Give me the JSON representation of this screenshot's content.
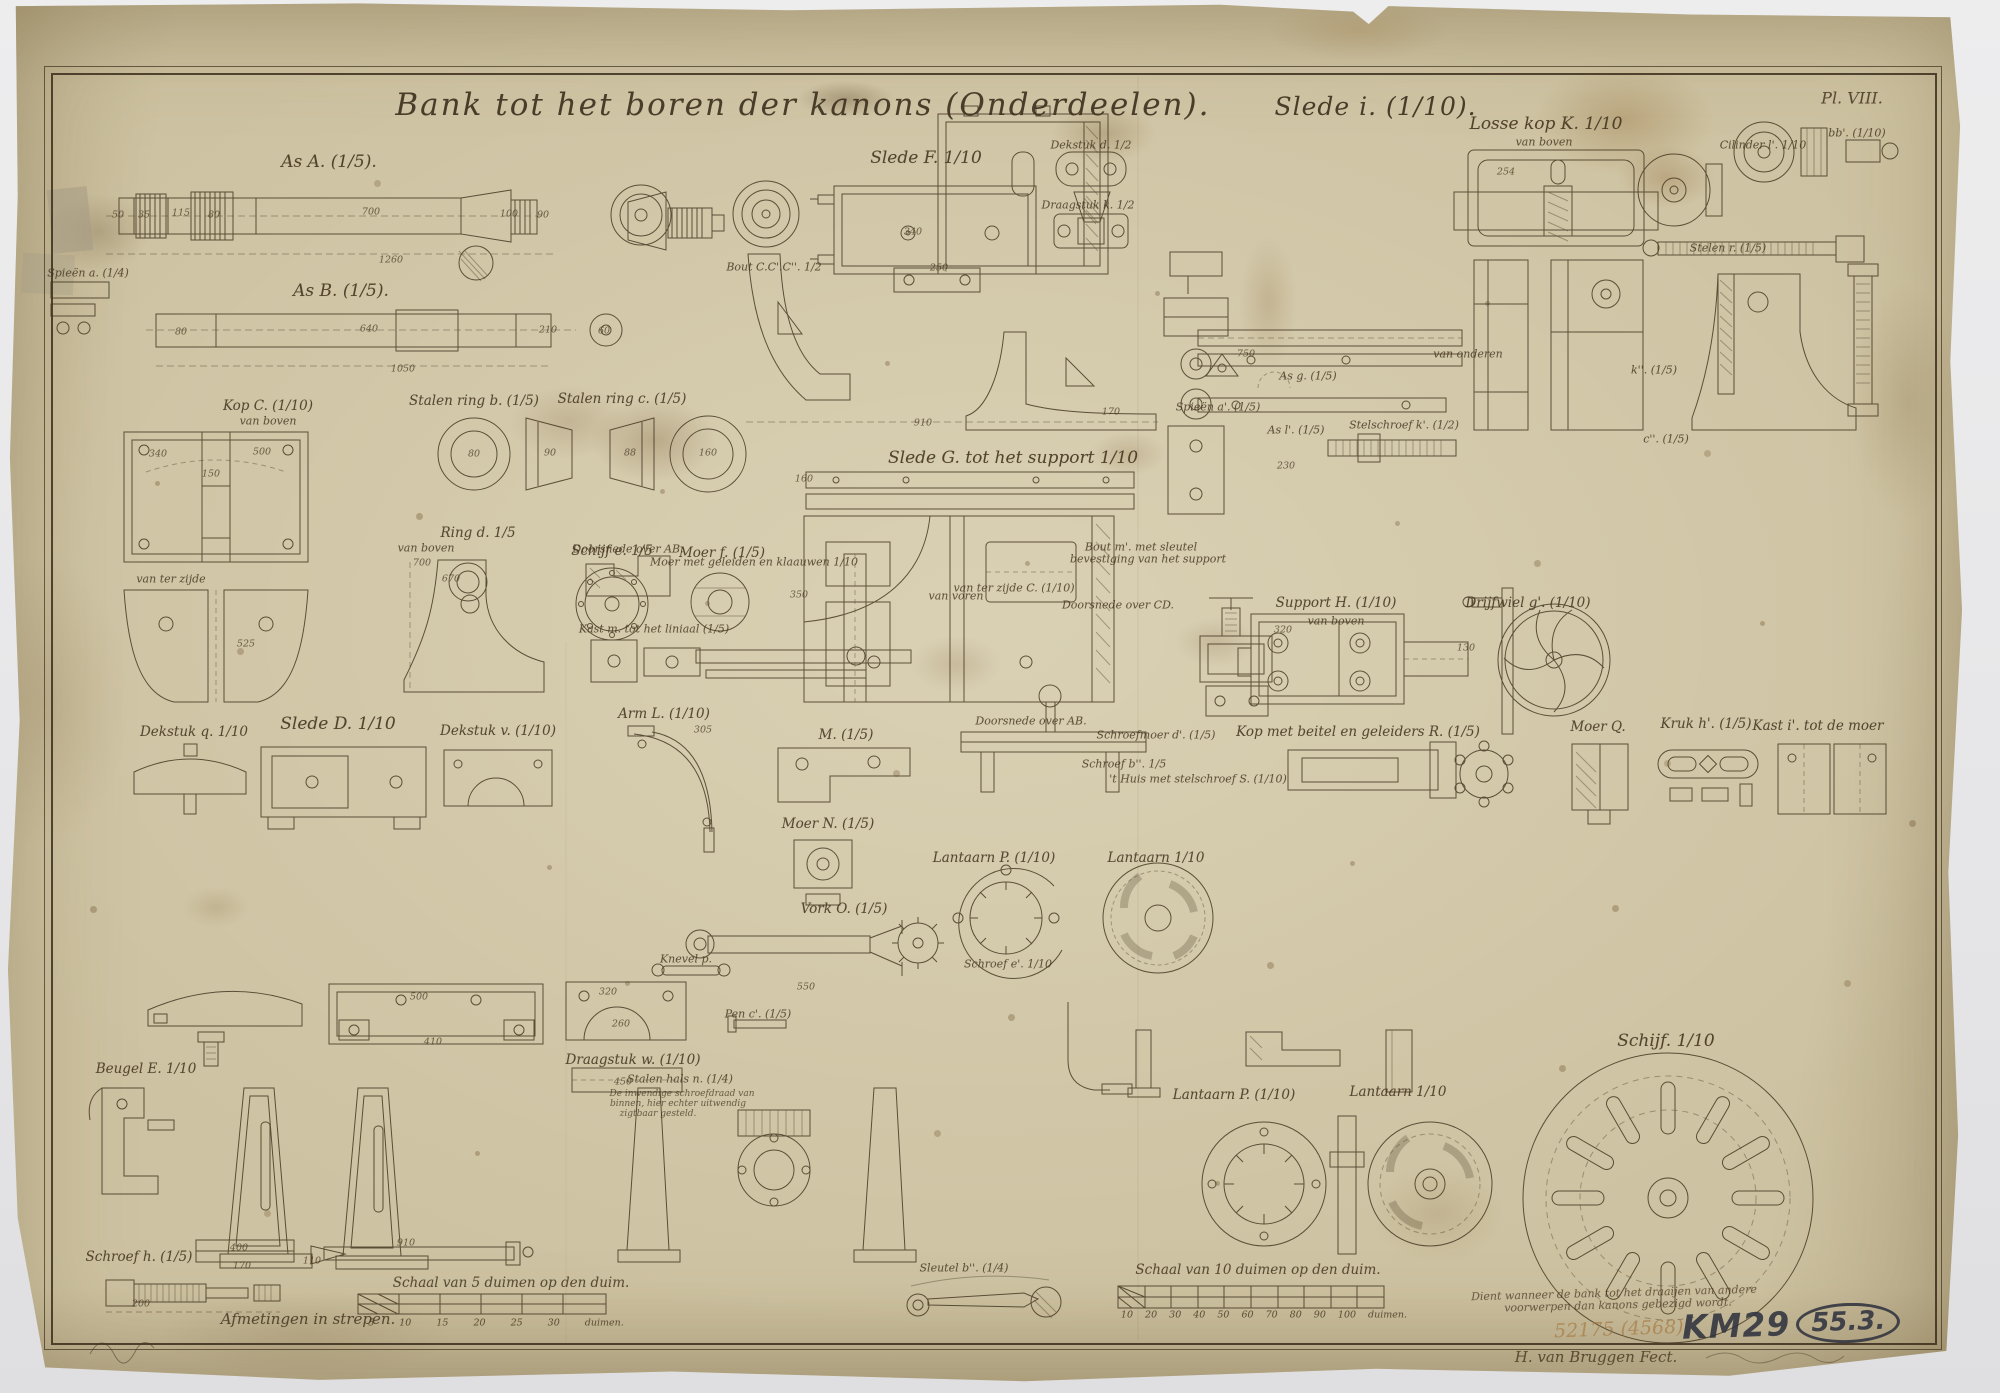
{
  "plate": {
    "title_main": "Bank tot het boren der kanons (Onderdeelen).",
    "title_suffix": "Slede i. (1/10).",
    "plate_number": "Pl. VIII.",
    "dimension_note": "Afmetingen in strepen.",
    "scale_left_caption": "Schaal van 5 duimen op den duim.",
    "scale_left_ticks": "5 10 15 20 25 30 duimen.",
    "scale_right_caption": "Schaal van 10 duimen op den duim.",
    "scale_right_ticks": "10 20 30 40 50 60 70 80 90 100 duimen.",
    "note_line1": "Dient wanneer de bank tot het draaijen van andere",
    "note_line2": "voorwerpen dan kanons gebezigd wordt.",
    "signature": "H. van Bruggen Fect.",
    "stamp_pencil": "52175 (4568).",
    "stamp_ink": "KM29",
    "stamp_ink_circled": "55.3."
  },
  "colors": {
    "paper": "#cdc2a1",
    "ink": "#41341f",
    "stamp_ink": "#30333f",
    "pencil": "#a57337"
  },
  "figure_labels": [
    {
      "t": "As A. (1/5).",
      "x": 323,
      "y": 160,
      "s": "l"
    },
    {
      "t": "As B. (1/5).",
      "x": 335,
      "y": 289,
      "s": "l"
    },
    {
      "t": "Spieën a. (1/4)",
      "x": 82,
      "y": 271,
      "s": "s"
    },
    {
      "t": "Kop C. (1/10)",
      "x": 262,
      "y": 404
    },
    {
      "t": "van boven",
      "x": 262,
      "y": 419,
      "s": "s"
    },
    {
      "t": "Stalen ring b. (1/5)",
      "x": 468,
      "y": 399
    },
    {
      "t": "Stalen ring c. (1/5)",
      "x": 616,
      "y": 397
    },
    {
      "t": "Ring d. 1/5",
      "x": 472,
      "y": 531
    },
    {
      "t": "Schijf e. 1/5",
      "x": 606,
      "y": 549
    },
    {
      "t": "Moer f. (1/5)",
      "x": 716,
      "y": 551
    },
    {
      "t": "van ter zijde",
      "x": 165,
      "y": 577,
      "s": "s"
    },
    {
      "t": "van boven",
      "x": 420,
      "y": 546,
      "s": "s"
    },
    {
      "t": "Slede F. 1/10",
      "x": 920,
      "y": 156,
      "s": "l"
    },
    {
      "t": "Bout C.C'.C''. 1/2",
      "x": 768,
      "y": 265,
      "s": "s"
    },
    {
      "t": "Dekstuk d. 1/2",
      "x": 1085,
      "y": 143,
      "s": "s"
    },
    {
      "t": "Draagstuk k. 1/2",
      "x": 1082,
      "y": 203,
      "s": "s"
    },
    {
      "t": "Slede G. tot het support 1/10",
      "x": 1007,
      "y": 456,
      "s": "l"
    },
    {
      "t": "Doorsnede over AB.",
      "x": 622,
      "y": 547,
      "s": "s"
    },
    {
      "t": "Moer met geleiden en klaauwen 1/10",
      "x": 748,
      "y": 560,
      "s": "s"
    },
    {
      "t": "Kast m. tot het liniaal (1/5)",
      "x": 648,
      "y": 627,
      "s": "s"
    },
    {
      "t": "Stelschroef k'. (1/2)",
      "x": 1398,
      "y": 423,
      "s": "s"
    },
    {
      "t": "As g. (1/5)",
      "x": 1302,
      "y": 374,
      "s": "s"
    },
    {
      "t": "As l'. (1/5)",
      "x": 1290,
      "y": 428,
      "s": "s"
    },
    {
      "t": "Spieën a'. (1/5)",
      "x": 1212,
      "y": 405,
      "s": "s"
    },
    {
      "t": "Support H. (1/10)",
      "x": 1330,
      "y": 601
    },
    {
      "t": "van boven",
      "x": 1330,
      "y": 619,
      "s": "s"
    },
    {
      "t": "Drijfwiel g'. (1/10)",
      "x": 1522,
      "y": 601
    },
    {
      "t": "Bout m'. met sleutel",
      "x": 1135,
      "y": 545,
      "s": "s"
    },
    {
      "t": "bevestiging van het support",
      "x": 1142,
      "y": 557,
      "s": "s"
    },
    {
      "t": "van ter zijde C. (1/10)",
      "x": 1008,
      "y": 586,
      "s": "s"
    },
    {
      "t": "van voren",
      "x": 950,
      "y": 594,
      "s": "s"
    },
    {
      "t": "Doorsnede over CD.",
      "x": 1112,
      "y": 603,
      "s": "s"
    },
    {
      "t": "Doorsnede over AB.",
      "x": 1025,
      "y": 719,
      "s": "s"
    },
    {
      "t": "Schroefmoer d'. (1/5)",
      "x": 1150,
      "y": 733,
      "s": "s"
    },
    {
      "t": "Schroef b''. 1/5",
      "x": 1118,
      "y": 762,
      "s": "s"
    },
    {
      "t": "'t Huis met stelschroef S. (1/10)",
      "x": 1192,
      "y": 777,
      "s": "s"
    },
    {
      "t": "Losse kop K. 1/10",
      "x": 1540,
      "y": 122,
      "s": "l"
    },
    {
      "t": "van boven",
      "x": 1538,
      "y": 140,
      "s": "s"
    },
    {
      "t": "bb'. (1/10)",
      "x": 1851,
      "y": 131,
      "s": "s"
    },
    {
      "t": "Cilinder l'. 1/10",
      "x": 1757,
      "y": 143,
      "s": "s"
    },
    {
      "t": "Stelen r. (1/5)",
      "x": 1722,
      "y": 246,
      "s": "s"
    },
    {
      "t": "van onderen",
      "x": 1462,
      "y": 352,
      "s": "s"
    },
    {
      "t": "k''. (1/5)",
      "x": 1648,
      "y": 368,
      "s": "s"
    },
    {
      "t": "c''. (1/5)",
      "x": 1660,
      "y": 437,
      "s": "s"
    },
    {
      "t": "Moer Q.",
      "x": 1592,
      "y": 725
    },
    {
      "t": "Kruk h'. (1/5)",
      "x": 1700,
      "y": 722
    },
    {
      "t": "Kast i'. tot de moer",
      "x": 1812,
      "y": 724
    },
    {
      "t": "Kop met beitel en geleiders R. (1/5)",
      "x": 1352,
      "y": 730
    },
    {
      "t": "Schijf. 1/10",
      "x": 1660,
      "y": 1039,
      "s": "l"
    },
    {
      "t": "Dekstuk q. 1/10",
      "x": 188,
      "y": 730
    },
    {
      "t": "Slede D. 1/10",
      "x": 332,
      "y": 722,
      "s": "l"
    },
    {
      "t": "Dekstuk v. (1/10)",
      "x": 492,
      "y": 729
    },
    {
      "t": "Draagstuk w. (1/10)",
      "x": 627,
      "y": 1058
    },
    {
      "t": "Beugel E. 1/10",
      "x": 140,
      "y": 1067
    },
    {
      "t": "Arm L. (1/10)",
      "x": 658,
      "y": 712
    },
    {
      "t": "M. (1/5)",
      "x": 840,
      "y": 733
    },
    {
      "t": "Moer N. (1/5)",
      "x": 822,
      "y": 822
    },
    {
      "t": "Stalen hals n. (1/4)",
      "x": 674,
      "y": 1077,
      "s": "s"
    },
    {
      "t": "De inwendige schroefdraad van",
      "x": 676,
      "y": 1092,
      "s": "xs"
    },
    {
      "t": "binnen, hier echter uitwendig",
      "x": 672,
      "y": 1102,
      "s": "xs"
    },
    {
      "t": "zigtbaar gesteld.",
      "x": 652,
      "y": 1112,
      "s": "xs"
    },
    {
      "t": "Vork O. (1/5)",
      "x": 838,
      "y": 907
    },
    {
      "t": "Knevel p.",
      "x": 680,
      "y": 957,
      "s": "s"
    },
    {
      "t": "Pen c'. (1/5)",
      "x": 752,
      "y": 1012,
      "s": "s"
    },
    {
      "t": "Lantaarn P. (1/10)",
      "x": 988,
      "y": 856
    },
    {
      "t": "Lantaarn 1/10",
      "x": 1150,
      "y": 856
    },
    {
      "t": "Schroef e'. 1/10",
      "x": 1002,
      "y": 962,
      "s": "s"
    },
    {
      "t": "Lantaarn P. (1/10)",
      "x": 1228,
      "y": 1093
    },
    {
      "t": "Lantaarn 1/10",
      "x": 1392,
      "y": 1090
    },
    {
      "t": "Sleutel b''. (1/4)",
      "x": 958,
      "y": 1266,
      "s": "s"
    },
    {
      "t": "Schroef h. (1/5)",
      "x": 133,
      "y": 1255
    }
  ],
  "dim_labels": [
    {
      "t": "50",
      "x": 112,
      "y": 213
    },
    {
      "t": "35",
      "x": 138,
      "y": 213
    },
    {
      "t": "115",
      "x": 175,
      "y": 211
    },
    {
      "t": "80",
      "x": 208,
      "y": 213
    },
    {
      "t": "700",
      "x": 365,
      "y": 210
    },
    {
      "t": "100",
      "x": 503,
      "y": 212
    },
    {
      "t": "90",
      "x": 537,
      "y": 213
    },
    {
      "t": "1260",
      "x": 385,
      "y": 258
    },
    {
      "t": "80",
      "x": 175,
      "y": 330
    },
    {
      "t": "640",
      "x": 363,
      "y": 327
    },
    {
      "t": "210",
      "x": 542,
      "y": 328
    },
    {
      "t": "60",
      "x": 598,
      "y": 329
    },
    {
      "t": "1050",
      "x": 397,
      "y": 367
    },
    {
      "t": "340",
      "x": 152,
      "y": 452
    },
    {
      "t": "500",
      "x": 256,
      "y": 450
    },
    {
      "t": "150",
      "x": 205,
      "y": 472
    },
    {
      "t": "525",
      "x": 240,
      "y": 642
    },
    {
      "t": "700",
      "x": 416,
      "y": 561
    },
    {
      "t": "670",
      "x": 445,
      "y": 577
    },
    {
      "t": "80",
      "x": 468,
      "y": 452
    },
    {
      "t": "90",
      "x": 544,
      "y": 451
    },
    {
      "t": "88",
      "x": 624,
      "y": 451
    },
    {
      "t": "160",
      "x": 702,
      "y": 451
    },
    {
      "t": "340",
      "x": 907,
      "y": 230
    },
    {
      "t": "250",
      "x": 933,
      "y": 266
    },
    {
      "t": "910",
      "x": 917,
      "y": 421
    },
    {
      "t": "750",
      "x": 1240,
      "y": 352
    },
    {
      "t": "170",
      "x": 1105,
      "y": 410
    },
    {
      "t": "160",
      "x": 798,
      "y": 477
    },
    {
      "t": "230",
      "x": 1280,
      "y": 464
    },
    {
      "t": "350",
      "x": 793,
      "y": 593
    },
    {
      "t": "320",
      "x": 1277,
      "y": 628
    },
    {
      "t": "130",
      "x": 1460,
      "y": 646
    },
    {
      "t": "305",
      "x": 697,
      "y": 728
    },
    {
      "t": "550",
      "x": 800,
      "y": 985
    },
    {
      "t": "320",
      "x": 602,
      "y": 990
    },
    {
      "t": "260",
      "x": 615,
      "y": 1022
    },
    {
      "t": "450",
      "x": 617,
      "y": 1080
    },
    {
      "t": "500",
      "x": 413,
      "y": 995
    },
    {
      "t": "410",
      "x": 427,
      "y": 1040
    },
    {
      "t": "400",
      "x": 233,
      "y": 1246
    },
    {
      "t": "910",
      "x": 400,
      "y": 1241
    },
    {
      "t": "110",
      "x": 306,
      "y": 1259
    },
    {
      "t": "170",
      "x": 236,
      "y": 1264
    },
    {
      "t": "200",
      "x": 135,
      "y": 1302
    },
    {
      "t": "254",
      "x": 1500,
      "y": 170
    }
  ]
}
